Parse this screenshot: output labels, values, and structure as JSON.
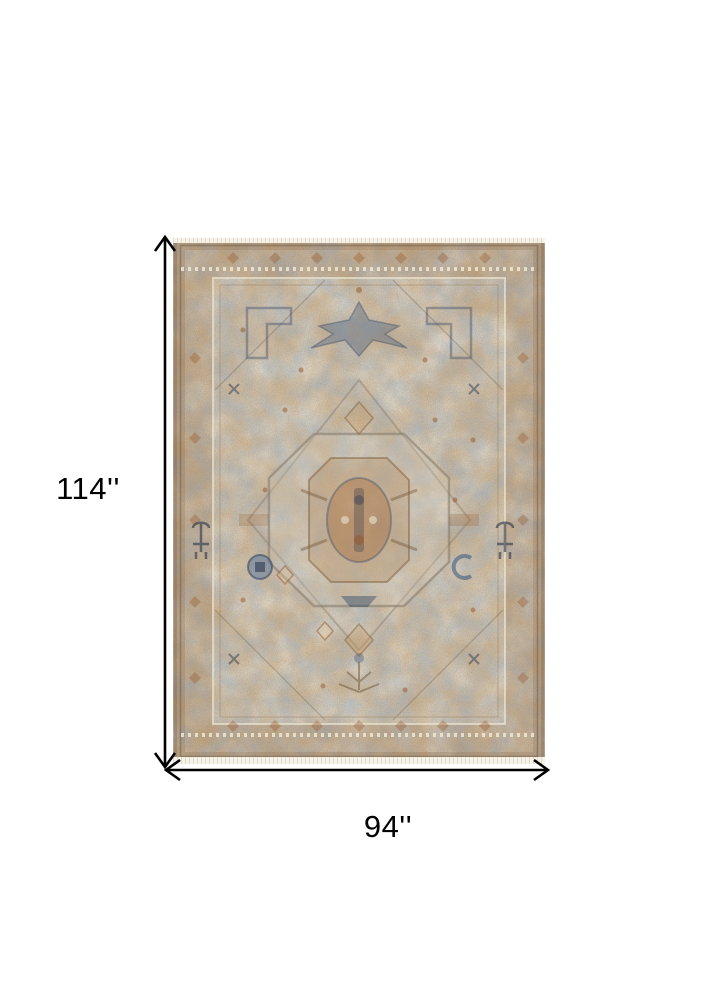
{
  "dimensions": {
    "height_label": "114''",
    "width_label": "94''"
  },
  "palette": {
    "arrow": "#000000",
    "label_text": "#000000",
    "rug_base": "#c9c0b0",
    "rug_rust": "#9a6136",
    "rug_blue": "#5f7a9b",
    "rug_navy": "#31435e",
    "rug_cream": "#efe9db",
    "rug_line": "#84796a"
  }
}
